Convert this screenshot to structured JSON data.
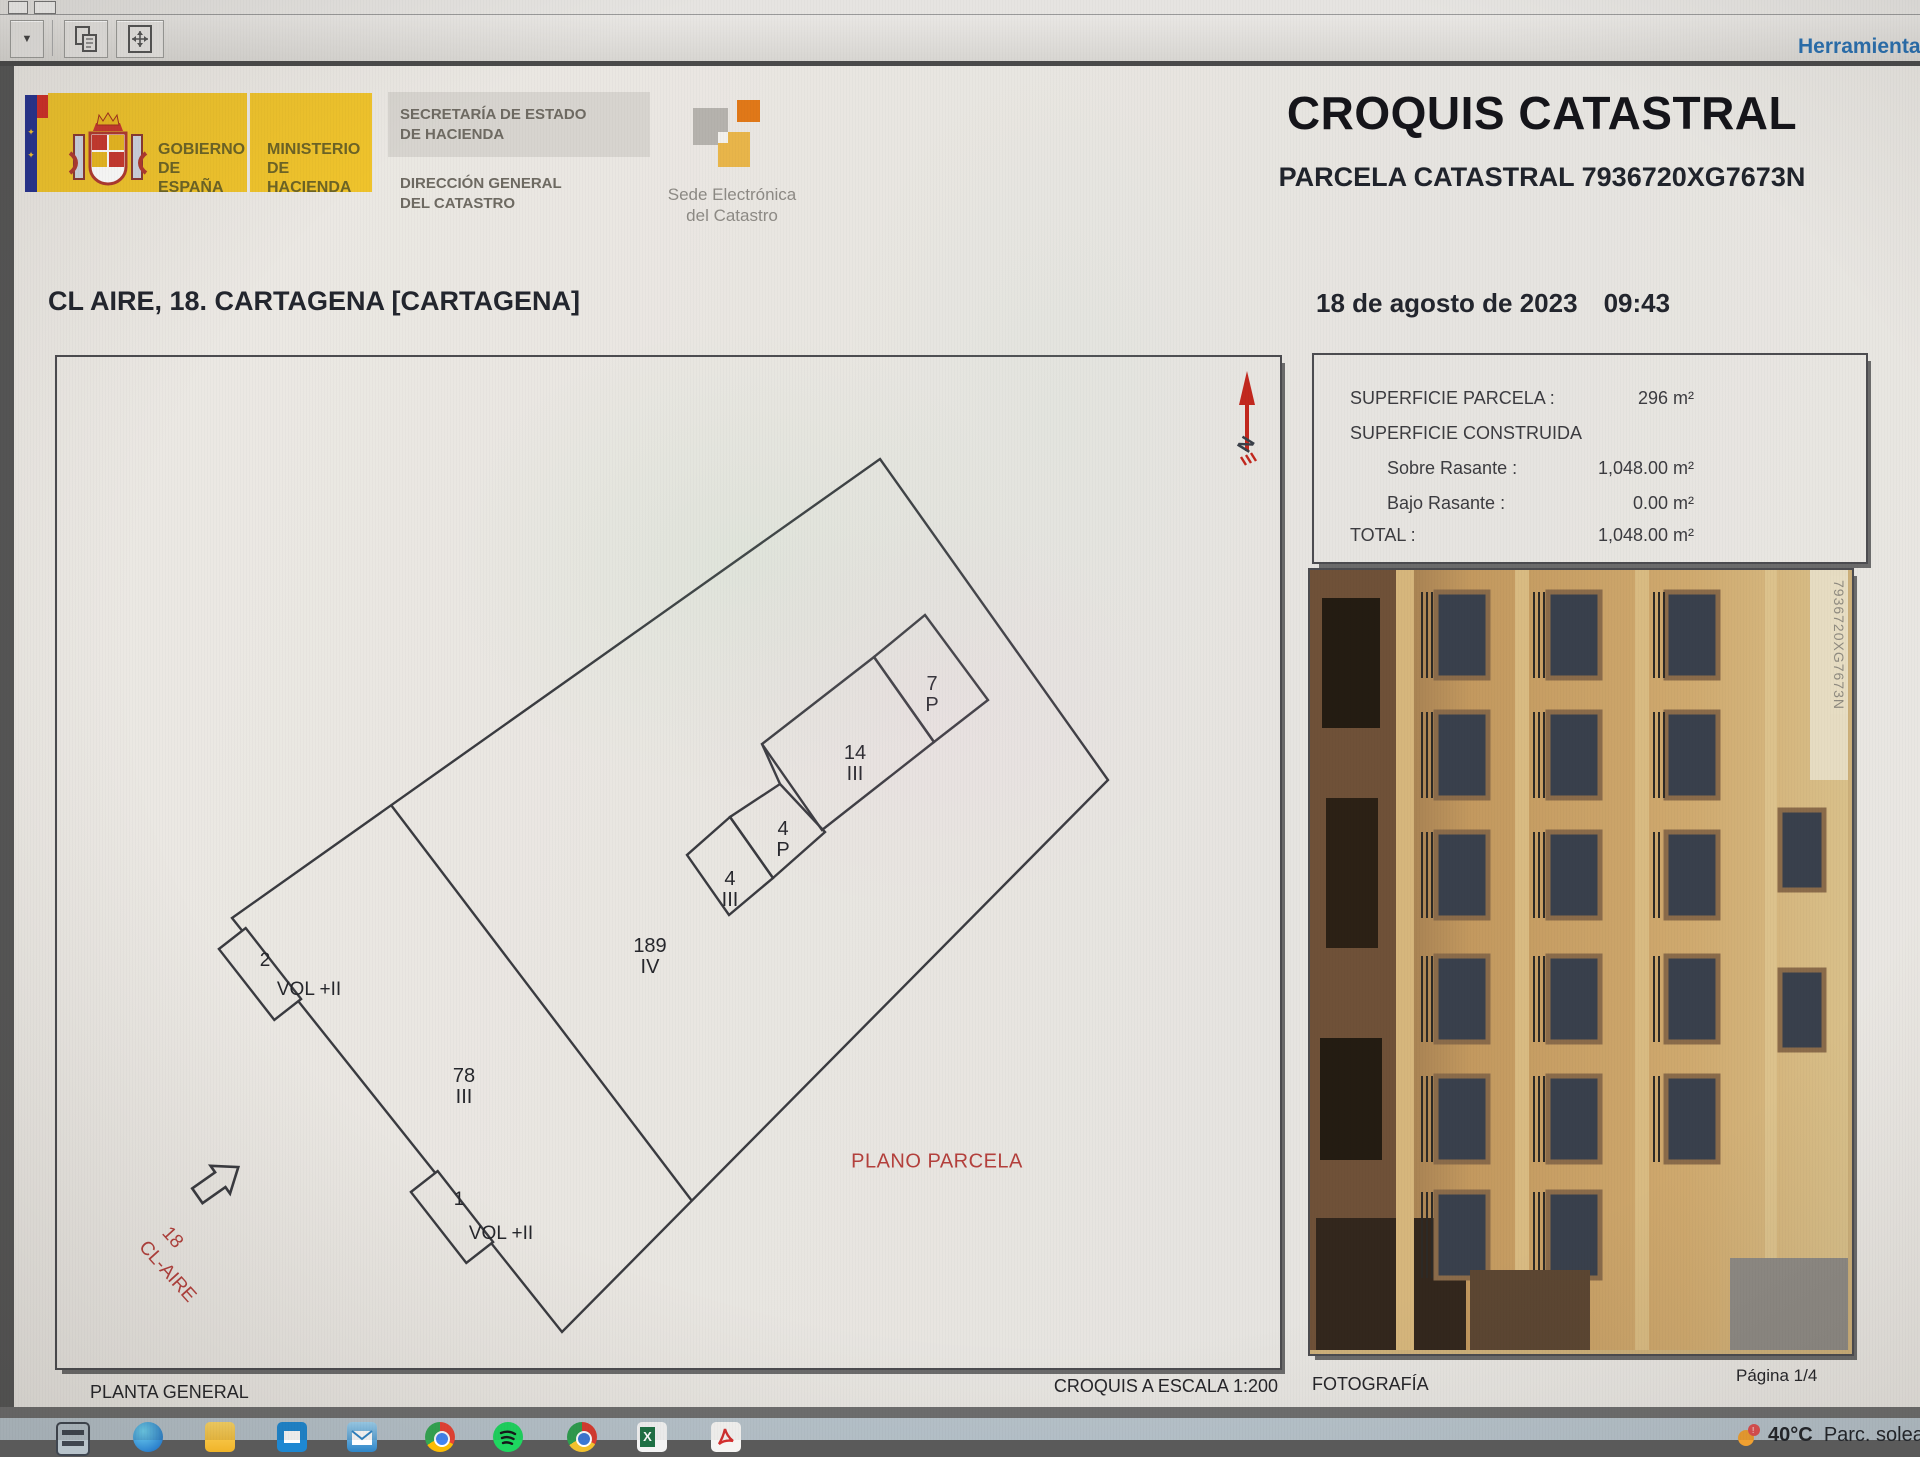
{
  "toolbar": {
    "herramientas": "Herramientas"
  },
  "header": {
    "gobierno": [
      "GOBIERNO",
      "DE ESPAÑA"
    ],
    "ministerio": [
      "MINISTERIO",
      "DE HACIENDA"
    ],
    "secretaria": [
      "SECRETARÍA DE ESTADO",
      "DE HACIENDA"
    ],
    "direccion": [
      "DIRECCIÓN GENERAL",
      "DEL CATASTRO"
    ],
    "sede": [
      "Sede Electrónica",
      "del Catastro"
    ],
    "title": "CROQUIS CATASTRAL",
    "subtitle": "PARCELA CATASTRAL 7936720XG7673N"
  },
  "meta": {
    "address": "CL AIRE, 18. CARTAGENA [CARTAGENA]",
    "date": "18 de agosto de 2023",
    "time": "09:43"
  },
  "info_panel": {
    "superficie_parcela_label": "SUPERFICIE PARCELA :",
    "superficie_parcela_value": "296 m²",
    "superficie_construida_label": "SUPERFICIE CONSTRUIDA",
    "sobre_rasante_label": "Sobre Rasante :",
    "sobre_rasante_value": "1,048.00 m²",
    "bajo_rasante_label": "Bajo Rasante :",
    "bajo_rasante_value": "0.00 m²",
    "total_label": "TOTAL :",
    "total_value": "1,048.00 m²"
  },
  "plan": {
    "north": "N",
    "plano_parcela": "PLANO PARCELA",
    "street": {
      "number": "18",
      "name": "CL-AIRE"
    },
    "parcels": {
      "p7": "7\nP",
      "p14": "14\nIII",
      "p4a": "4\nP",
      "p4b": "4\nIII",
      "p189": "189\nIV",
      "p78": "78\nIII"
    },
    "volumes": {
      "v2": {
        "num": "2",
        "label": "VOL +II"
      },
      "v1": {
        "num": "1",
        "label": "VOL +II"
      }
    }
  },
  "footer": {
    "planta_general": "PLANTA GENERAL",
    "escala": "CROQUIS A ESCALA 1:200",
    "fotografia": "FOTOGRAFÍA",
    "pagina": "Página 1/4"
  },
  "photo": {
    "ref": "7936720XG7673N"
  },
  "taskbar": {
    "weather_temp": "40°C",
    "weather_text": "Parc. solea"
  },
  "colors": {
    "logo_yellow": "#efc32c",
    "flag_blue": "#27338f",
    "flag_red": "#cf3028",
    "sede_orange": "#e07818",
    "sede_amber": "#e8b54a",
    "red_label": "#b4403c",
    "north_red": "#c2271d",
    "toolbar_link": "#2a6fae",
    "taskbar_bg": "#b7c3cb"
  }
}
